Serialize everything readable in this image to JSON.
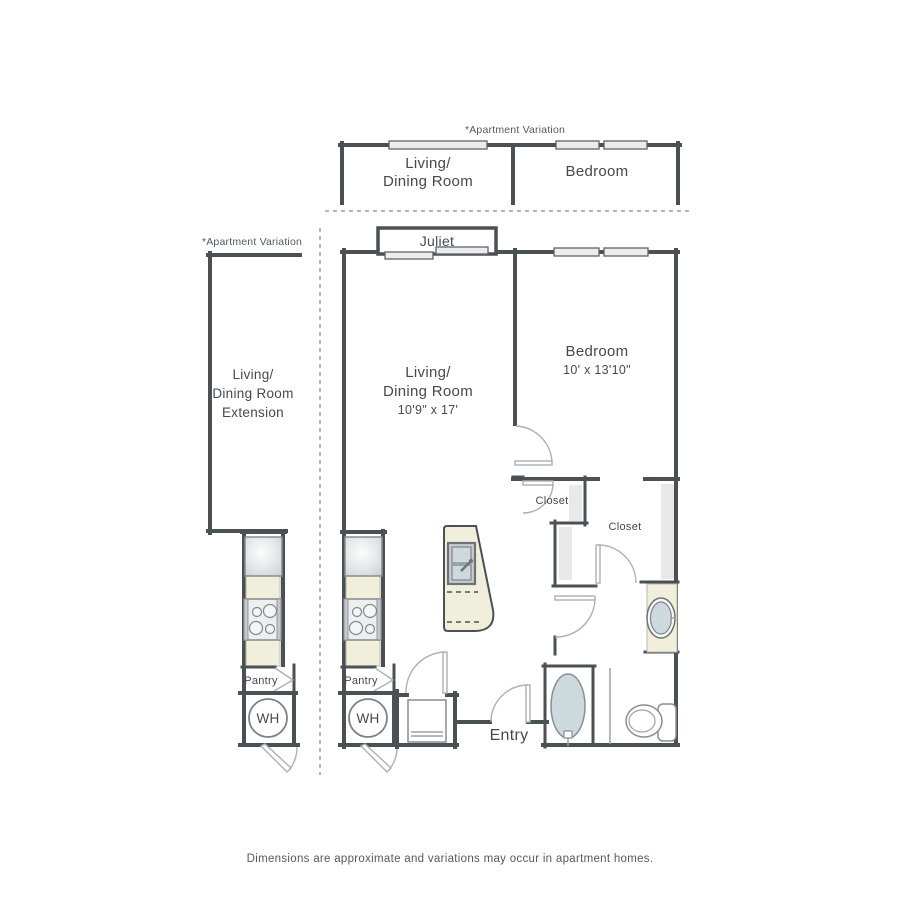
{
  "colors": {
    "wall": "#4b5055",
    "window_fill": "#eaecee",
    "counter_beige": "#f1efdc",
    "water_fill": "#ccd9dd",
    "label_text": "#45494e",
    "note_text": "#55595e",
    "background": "#ffffff"
  },
  "top_variation": {
    "note": "*Apartment Variation",
    "living_line1": "Living/",
    "living_line2": "Dining Room",
    "bedroom": "Bedroom"
  },
  "left_variation": {
    "note": "*Apartment Variation",
    "line1": "Living/",
    "line2": "Dining Room",
    "line3": "Extension",
    "pantry": "Pantry",
    "wh": "WH"
  },
  "main": {
    "juliet": "Juliet",
    "living": {
      "line1": "Living/",
      "line2": "Dining Room",
      "dims": "10'9\" x 17'"
    },
    "bedroom": {
      "name": "Bedroom",
      "dims": "10' x 13'10\""
    },
    "closet_small": "Closet",
    "closet_walkin": "Closet",
    "pantry": "Pantry",
    "wh": "WH",
    "entry": "Entry"
  },
  "footer": {
    "disclaimer": "Dimensions are approximate and variations may occur in apartment homes."
  }
}
